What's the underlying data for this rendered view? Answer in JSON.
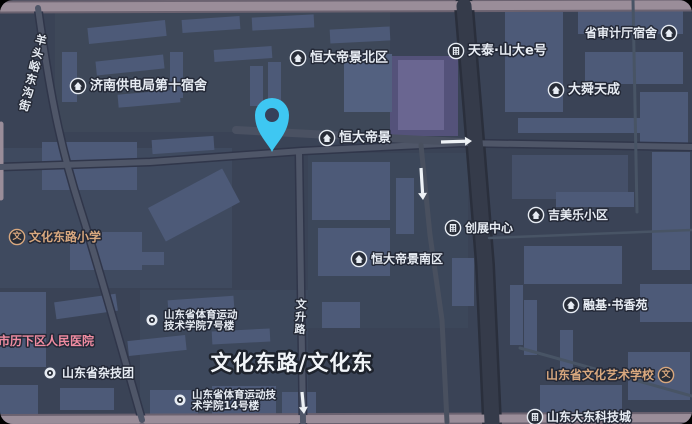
{
  "map": {
    "colors": {
      "bg": "#3a4356",
      "building": "#4d5a78",
      "building_light": "#536180",
      "building_dark": "#455069",
      "building_purple": "#6a6691",
      "parcel_purple": "#54527a",
      "label": "#e7ecf3",
      "label_tan": "#d9a87e",
      "label_pink": "#f08ca1",
      "pin": "#3ec7f2",
      "pin_hole": "#36415a",
      "road_main": "#9a8d99",
      "road_main_casing": "#6b6270",
      "road_minor": "#4f5668",
      "road_minor_casing": "#30364a",
      "road_dark": "#353b4a",
      "road_dark_casing": "#2a2f3c",
      "arrow": "#eef2f6",
      "icon_bg": "#272c37",
      "icon_fg": "#e7ecf3"
    },
    "parcels": [
      [
        55,
        12,
        335,
        120,
        "#3e4859"
      ],
      [
        0,
        148,
        232,
        140,
        "#3f4a5f"
      ],
      [
        308,
        153,
        160,
        175,
        "#3c475a"
      ],
      [
        140,
        290,
        168,
        130,
        "#3d485c"
      ],
      [
        390,
        56,
        68,
        80,
        "#54527a"
      ]
    ],
    "buildings": [
      [
        88,
        24,
        78,
        16,
        -6,
        "b"
      ],
      [
        182,
        18,
        58,
        13,
        -4,
        "b"
      ],
      [
        252,
        16,
        62,
        13,
        -3,
        "b"
      ],
      [
        62,
        52,
        15,
        50,
        0,
        "b"
      ],
      [
        96,
        58,
        68,
        14,
        -6,
        "b"
      ],
      [
        118,
        92,
        62,
        13,
        -5,
        "b"
      ],
      [
        170,
        52,
        13,
        46,
        0,
        "b"
      ],
      [
        214,
        48,
        58,
        12,
        -4,
        "b"
      ],
      [
        250,
        66,
        13,
        40,
        0,
        "b"
      ],
      [
        330,
        28,
        60,
        14,
        -3,
        "b"
      ],
      [
        344,
        54,
        48,
        58,
        0,
        "l"
      ],
      [
        268,
        62,
        13,
        42,
        0,
        "b"
      ],
      [
        398,
        60,
        46,
        70,
        0,
        "p"
      ],
      [
        505,
        12,
        58,
        100,
        0,
        "b"
      ],
      [
        578,
        8,
        105,
        26,
        0,
        "b"
      ],
      [
        585,
        52,
        98,
        32,
        0,
        "b"
      ],
      [
        640,
        92,
        48,
        56,
        0,
        "b"
      ],
      [
        518,
        118,
        164,
        15,
        0,
        "b"
      ],
      [
        512,
        155,
        116,
        44,
        0,
        "d"
      ],
      [
        652,
        152,
        38,
        46,
        0,
        "b"
      ],
      [
        556,
        192,
        78,
        15,
        0,
        "b"
      ],
      [
        652,
        196,
        38,
        74,
        0,
        "b"
      ],
      [
        524,
        246,
        98,
        38,
        0,
        "b"
      ],
      [
        640,
        284,
        52,
        38,
        0,
        "b"
      ],
      [
        524,
        300,
        13,
        55,
        0,
        "b"
      ],
      [
        510,
        285,
        13,
        60,
        0,
        "b"
      ],
      [
        312,
        162,
        78,
        58,
        0,
        "b"
      ],
      [
        318,
        228,
        72,
        48,
        0,
        "b"
      ],
      [
        396,
        178,
        18,
        56,
        0,
        "b"
      ],
      [
        452,
        258,
        22,
        48,
        0,
        "b"
      ],
      [
        42,
        142,
        95,
        48,
        0,
        "b"
      ],
      [
        152,
        138,
        62,
        14,
        -4,
        "b"
      ],
      [
        152,
        186,
        84,
        38,
        -28,
        "b"
      ],
      [
        70,
        232,
        72,
        38,
        0,
        "b"
      ],
      [
        122,
        252,
        42,
        13,
        0,
        "b"
      ],
      [
        0,
        292,
        46,
        75,
        0,
        "b"
      ],
      [
        55,
        298,
        62,
        17,
        -8,
        "b"
      ],
      [
        128,
        338,
        58,
        15,
        -6,
        "b"
      ],
      [
        60,
        388,
        54,
        22,
        0,
        "b"
      ],
      [
        0,
        385,
        38,
        30,
        0,
        "b"
      ],
      [
        168,
        298,
        66,
        14,
        -4,
        "b"
      ],
      [
        212,
        330,
        58,
        13,
        -3,
        "b"
      ],
      [
        322,
        302,
        38,
        26,
        0,
        "b"
      ],
      [
        150,
        390,
        48,
        26,
        0,
        "b"
      ],
      [
        212,
        386,
        64,
        30,
        0,
        "b"
      ],
      [
        282,
        392,
        34,
        26,
        0,
        "b"
      ],
      [
        540,
        385,
        82,
        32,
        0,
        "b"
      ],
      [
        628,
        352,
        62,
        48,
        0,
        "b"
      ],
      [
        560,
        330,
        13,
        40,
        0,
        "b"
      ]
    ],
    "roads": [
      {
        "d": "M0,7 L692,5",
        "w": 9,
        "c": "road_main",
        "cw": 13,
        "cc": "road_main_casing"
      },
      {
        "d": "M0,420 L692,418",
        "w": 8,
        "c": "road_main",
        "cw": 12,
        "cc": "road_main_casing"
      },
      {
        "d": "M1,124 L1,198",
        "w": 5,
        "c": "road_main"
      },
      {
        "d": "M38,8 C48,80 58,140 80,208 C98,264 118,336 142,420",
        "w": 6,
        "c": "road_minor",
        "cw": 9,
        "cc": "road_minor_casing"
      },
      {
        "d": "M0,167 L150,162 L302,151 L462,143 L692,147",
        "w": 6,
        "c": "road_minor",
        "cw": 9,
        "cc": "road_minor_casing"
      },
      {
        "d": "M236,130 L462,142",
        "w": 8,
        "c": "#4a5162"
      },
      {
        "d": "M299,152 L303,422",
        "w": 6,
        "c": "road_minor",
        "cw": 9,
        "cc": "road_minor_casing"
      },
      {
        "d": "M421,145 L430,235 L442,320 L447,422",
        "w": 5,
        "c": "#49505f"
      },
      {
        "d": "M464,6 L473,115 L485,265 L492,422",
        "w": 15,
        "c": "road_dark",
        "cw": 20,
        "cc": "road_dark_casing"
      },
      {
        "d": "M633,0 L637,212",
        "w": 3,
        "c": "#485465"
      },
      {
        "d": "M489,238 L692,230",
        "w": 2.5,
        "c": "#485465"
      },
      {
        "d": "M520,348 L692,396",
        "w": 3,
        "c": "#485465"
      }
    ],
    "arrows": [
      {
        "x1": 441,
        "y1": 142,
        "x2": 472,
        "y2": 141
      },
      {
        "x1": 421,
        "y1": 168,
        "x2": 423,
        "y2": 200
      },
      {
        "x1": 302,
        "y1": 392,
        "x2": 304,
        "y2": 414
      }
    ],
    "poi_labels": [
      {
        "text": "济南供电局第十宿舍",
        "x": 90,
        "y": 86,
        "icon": "house",
        "side": "left",
        "fs": 13
      },
      {
        "text": "恒大帝景北区",
        "x": 310,
        "y": 58,
        "icon": "house",
        "side": "left",
        "fs": 13
      },
      {
        "text": "省审计厅宿舍",
        "x": 657,
        "y": 33,
        "icon": "house",
        "side": "right",
        "fs": 12,
        "anchor": "end"
      },
      {
        "text": "天泰·山大e号",
        "x": 468,
        "y": 51,
        "icon": "building",
        "side": "left",
        "fs": 13
      },
      {
        "text": "大舜天成",
        "x": 568,
        "y": 90,
        "icon": "house",
        "side": "left",
        "fs": 13
      },
      {
        "text": "恒大帝景",
        "x": 339,
        "y": 138,
        "icon": "house",
        "side": "left",
        "fs": 13
      },
      {
        "text": "吉美乐小区",
        "x": 548,
        "y": 215,
        "icon": "house",
        "side": "left",
        "fs": 12
      },
      {
        "text": "创展中心",
        "x": 465,
        "y": 228,
        "icon": "building",
        "side": "left",
        "fs": 12
      },
      {
        "text": "文化东路小学",
        "x": 29,
        "y": 237,
        "icon": "school",
        "side": "left",
        "fs": 12,
        "color": "tan"
      },
      {
        "text": "恒大帝景南区",
        "x": 371,
        "y": 259,
        "icon": "house",
        "side": "left",
        "fs": 12
      },
      {
        "text": "市历下区人民医院",
        "x": -2,
        "y": 341,
        "icon": "none",
        "fs": 12,
        "color": "pink"
      },
      {
        "text": "山东省杂技团",
        "x": 62,
        "y": 373,
        "icon": "dot",
        "side": "left",
        "fs": 12
      },
      {
        "lines": [
          "山东省体育运动",
          "技术学院7号楼"
        ],
        "x": 164,
        "y": 315,
        "icon": "dot",
        "side": "left",
        "fs": 10.5,
        "lh": 11
      },
      {
        "lines": [
          "山东省体育运动技",
          "术学院14号楼"
        ],
        "x": 192,
        "y": 395,
        "icon": "dot",
        "side": "left",
        "fs": 10.5,
        "lh": 11
      },
      {
        "text": "融基·书香苑",
        "x": 583,
        "y": 305,
        "icon": "house",
        "side": "left",
        "fs": 12
      },
      {
        "text": "山东省文化艺术学校",
        "x": 654,
        "y": 375,
        "icon": "school",
        "side": "right",
        "fs": 12,
        "color": "tan",
        "anchor": "end"
      },
      {
        "text": "山东大东科技城",
        "x": 547,
        "y": 417,
        "icon": "building",
        "side": "left",
        "fs": 12
      }
    ],
    "vertical_road_labels": [
      {
        "text": "羊头峪东沟街",
        "x": 40,
        "y": 44,
        "rot": 14,
        "fs": 11.5,
        "lh": 13.5
      },
      {
        "text": "文升路",
        "x": 301,
        "y": 308,
        "rot": 3,
        "fs": 11,
        "lh": 12.5
      }
    ],
    "big_road_label": {
      "text": "文化东路/文化东",
      "x": 292,
      "y": 363,
      "fs": 21
    },
    "pin": {
      "cx": 272,
      "cy": 115,
      "r": 17,
      "tip_y": 152
    }
  }
}
